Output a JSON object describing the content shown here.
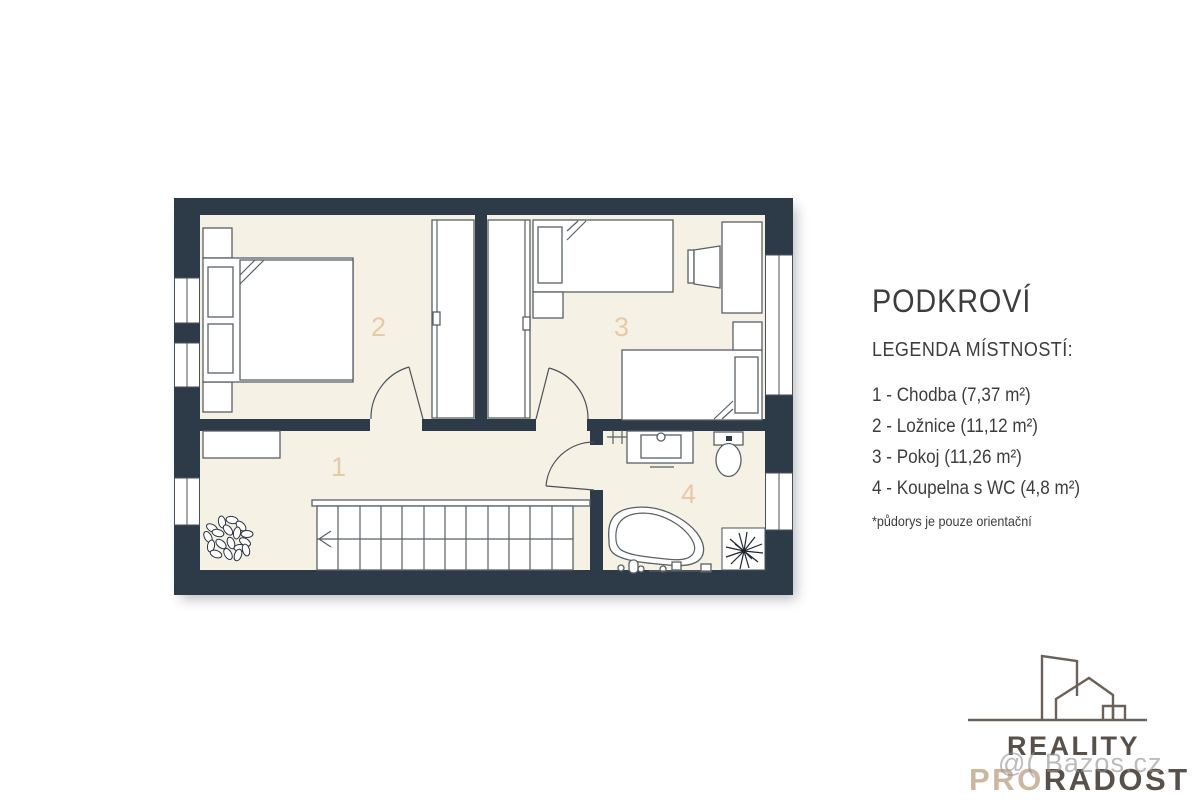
{
  "colors": {
    "wall": "#2d3a47",
    "floor": "#f6f1e5",
    "room_label": "#e8c9a6",
    "text": "#3d3d3d",
    "logo_dark": "#58514b",
    "logo_tan": "#cdb69f",
    "watermark": "#8f8f8f"
  },
  "plan": {
    "room_numbers": {
      "hallway": "1",
      "bedroom": "2",
      "kids_room": "3",
      "bathroom": "4"
    }
  },
  "legend": {
    "title": "PODKROVÍ",
    "subtitle": "LEGENDA MÍSTNOSTÍ:",
    "items": [
      "1 - Chodba (7,37 m²)",
      "2 - Ložnice (11,12 m²)",
      "3 - Pokoj (11,26 m²)",
      "4 - Koupelna s WC (4,8 m²)"
    ],
    "note": "*půdorys je pouze orientační"
  },
  "logo": {
    "reality": "REALITY",
    "pro": "PRO",
    "radost": "RADOST"
  },
  "watermark": "@( Bazos.cz"
}
